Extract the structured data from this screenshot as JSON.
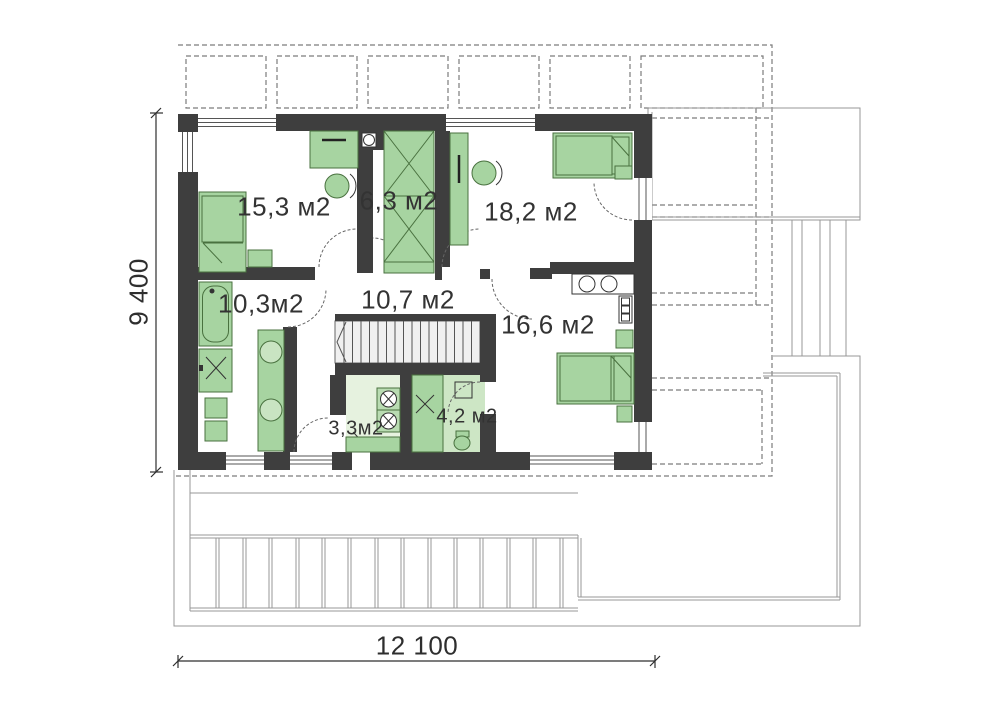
{
  "plan": {
    "type": "floor-plan",
    "rooms": [
      {
        "name": "bedroom-1",
        "area_label": "15,3 м2"
      },
      {
        "name": "closet",
        "area_label": "6,3 м2"
      },
      {
        "name": "bedroom-2",
        "area_label": "18,2 м2"
      },
      {
        "name": "bathroom",
        "area_label": "10,3м2"
      },
      {
        "name": "hall",
        "area_label": "10,7 м2"
      },
      {
        "name": "bedroom-3",
        "area_label": "16,6 м2"
      },
      {
        "name": "laundry",
        "area_label": "3,3м2"
      },
      {
        "name": "ensuite-bathroom",
        "area_label": "4,2 м2"
      }
    ],
    "dimensions": {
      "overall_width": "12 100",
      "overall_depth": "9 400"
    },
    "colors": {
      "wall": "#3e3e3e",
      "furniture": "#a7d4a1",
      "furniture_stroke": "#49713f",
      "floor_light": "#e6f2df",
      "floor_mid": "#cde6c5",
      "stairs_fill": "#f0f0f0",
      "terrace_line": "#979797",
      "roof_dash": "#7c7c7c",
      "dimension_text": "#2e2e2e"
    }
  }
}
